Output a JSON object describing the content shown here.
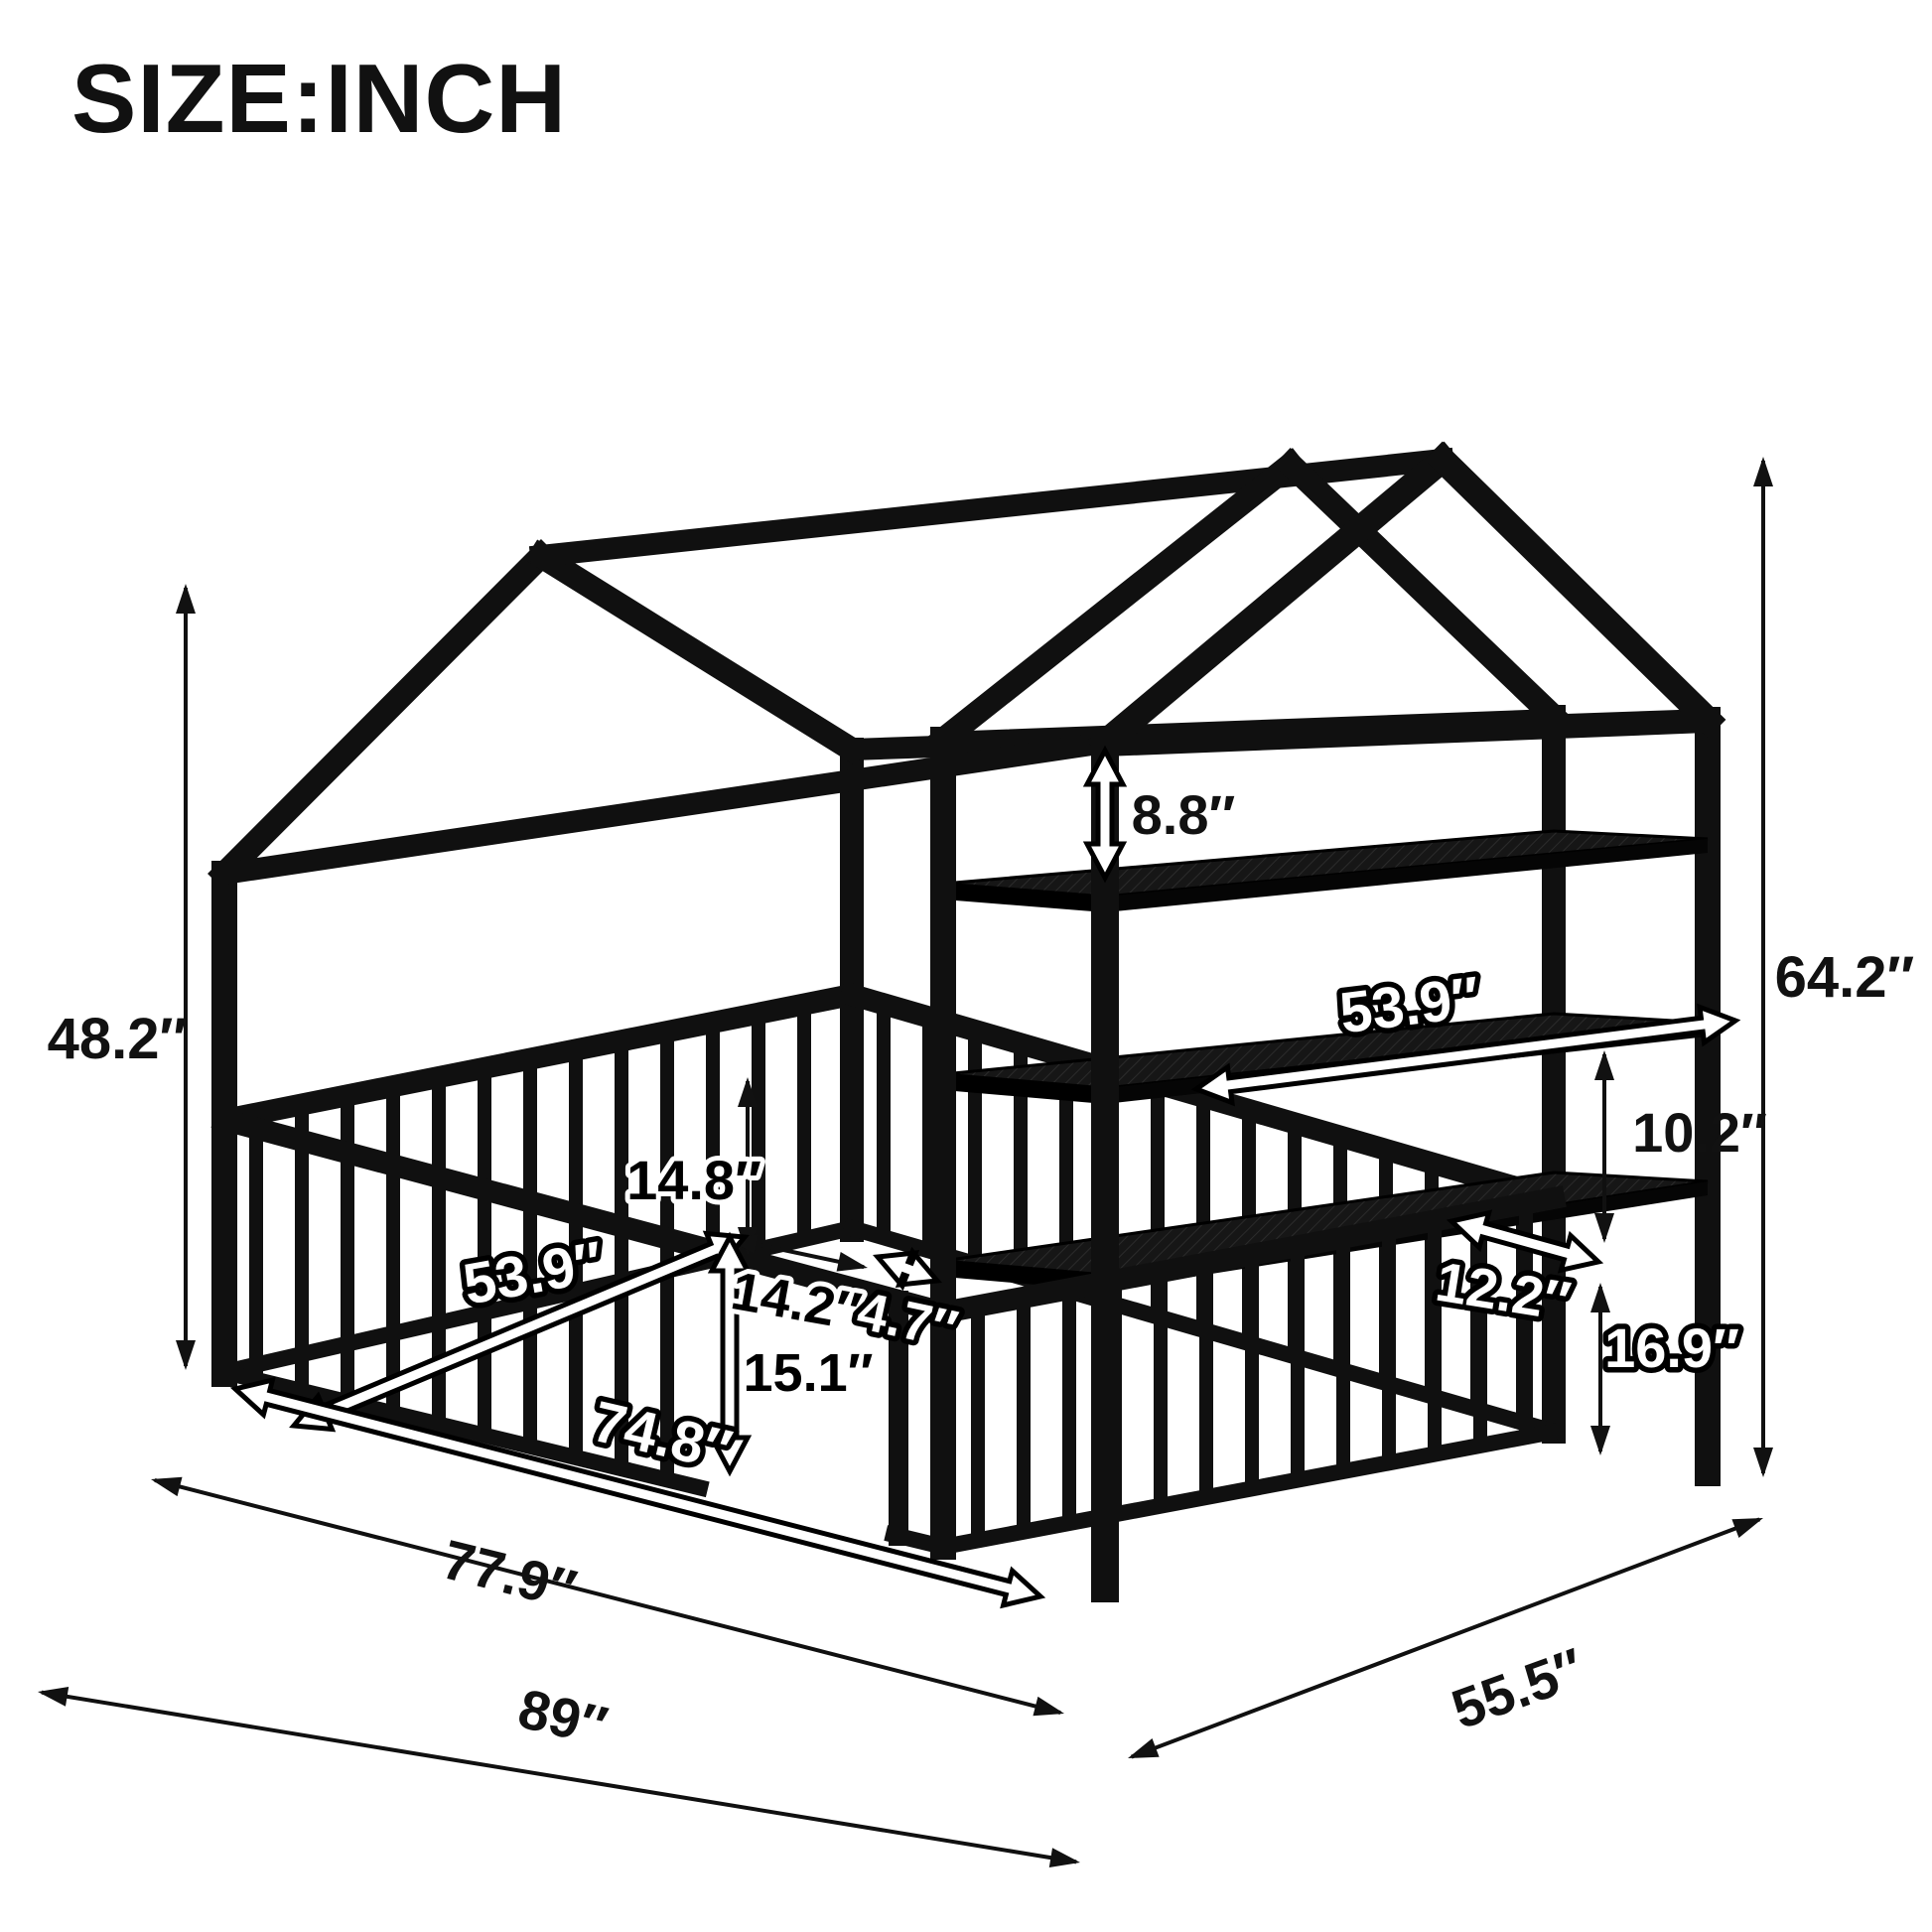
{
  "title": "SIZE:INCH",
  "unit": "inch",
  "subject": "house-shaped kids bed frame with guardrail fence, entry opening and 3-tier foot-end storage shelves",
  "colors": {
    "background": "#ffffff",
    "frame": "#101010",
    "dimension_line": "#111111",
    "outlined_arrow_fill": "#ffffff",
    "label_text": "#111111"
  },
  "dimensions": {
    "wall_height": "48.2″",
    "overall_height": "64.2″",
    "roof_to_top_shelf": "8.8″",
    "shelf_length": "53.9″",
    "shelf_gap": "10.2″",
    "shelf_depth": "12.2″",
    "shelf_to_rail": "16.9″",
    "rail_height": "14.8″",
    "rail_length": "53.9″",
    "gate_width": "14.2″",
    "gate_side_gap": "4.7″",
    "gate_height": "15.1″",
    "inner_length": "74.8″",
    "frame_length": "77.9″",
    "overall_length": "89″",
    "overall_width": "55.5″"
  }
}
